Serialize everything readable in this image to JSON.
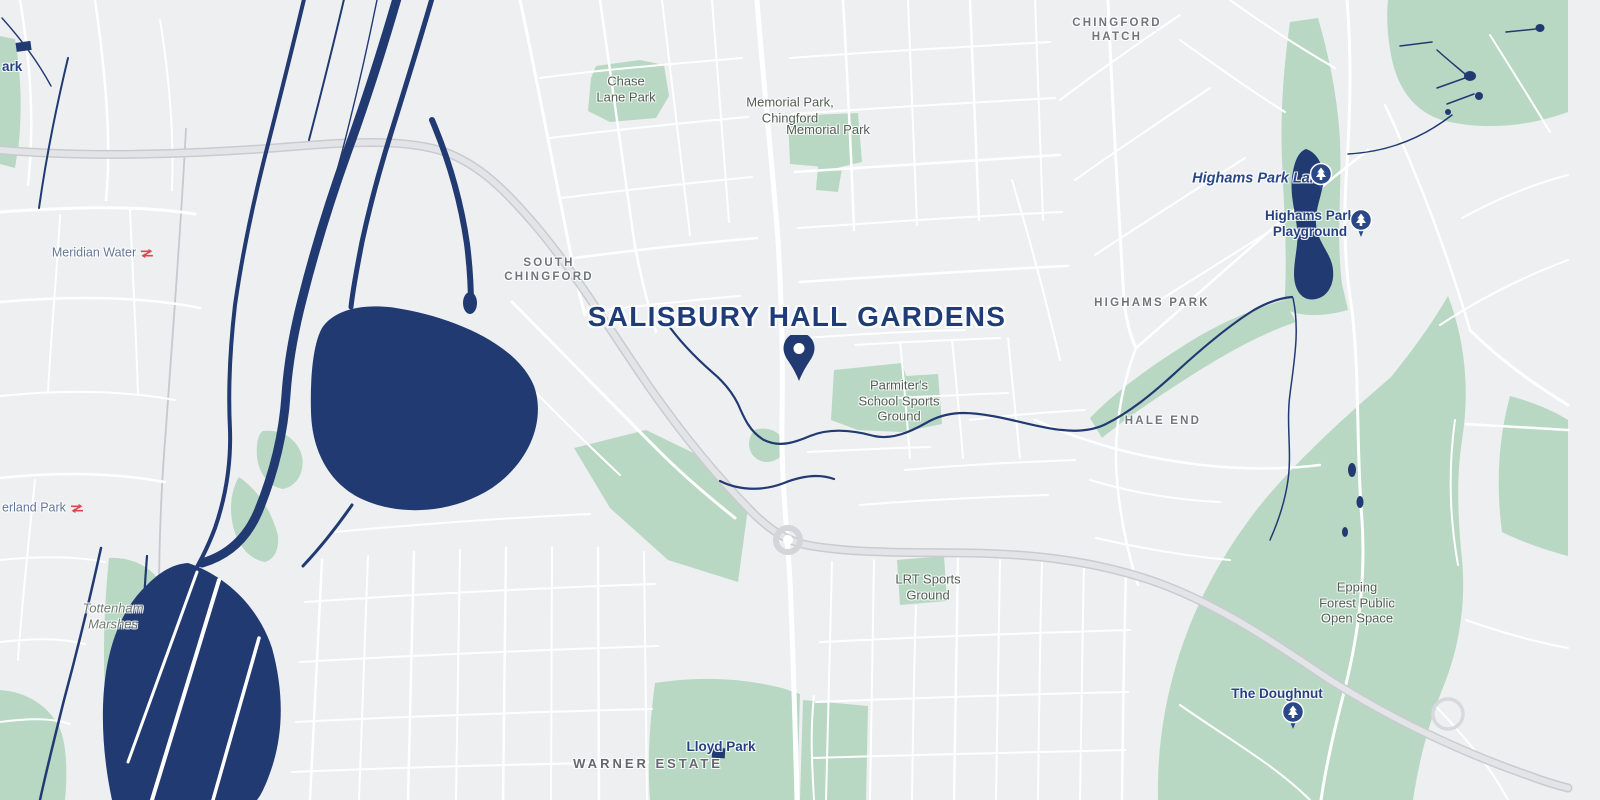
{
  "map": {
    "marker": {
      "title": "SALISBURY HALL GARDENS",
      "icon": "map-pin-icon"
    },
    "colors": {
      "bg": "#edeff1",
      "road": "#ffffff",
      "hwy": "#e3e4e7",
      "hwycase": "#c9cbcf",
      "water": "#223a72",
      "green": "#b8d8c3",
      "navy": "#1e3c78"
    },
    "icons": {
      "location_pin": "map-pin-icon",
      "tree_pin": "tree-pin-icon",
      "rail": "national-rail-icon"
    },
    "labels": [
      {
        "text": "CHINGFORD\nHATCH",
        "type": "area",
        "x": 1117,
        "y": 31
      },
      {
        "text": "SOUTH\nCHINGFORD",
        "type": "area",
        "x": 549,
        "y": 271
      },
      {
        "text": "HIGHAMS PARK",
        "type": "area",
        "x": 1152,
        "y": 304
      },
      {
        "text": "HALE END",
        "type": "area",
        "x": 1163,
        "y": 422
      },
      {
        "text": "WARNER ESTATE",
        "type": "area-lg",
        "x": 648,
        "y": 764
      },
      {
        "text": "Chase\nLane Park",
        "type": "park",
        "x": 626,
        "y": 89
      },
      {
        "text": "Memorial Park,\nChingford",
        "type": "park",
        "x": 790,
        "y": 110
      },
      {
        "text": "Memorial Park",
        "type": "park",
        "x": 828,
        "y": 130
      },
      {
        "text": "Parmiter's\nSchool Sports\nGround",
        "type": "park",
        "x": 899,
        "y": 401
      },
      {
        "text": "LRT Sports\nGround",
        "type": "park",
        "x": 928,
        "y": 587
      },
      {
        "text": "Epping\nForest Public\nOpen Space",
        "type": "park",
        "x": 1357,
        "y": 603
      },
      {
        "text": "The Doughnut",
        "type": "poi",
        "x": 1277,
        "y": 694
      },
      {
        "text": "Lloyd Park",
        "type": "poi",
        "x": 721,
        "y": 747
      },
      {
        "text": "Highams Park\nPlayground",
        "type": "poi",
        "x": 1310,
        "y": 224
      },
      {
        "text": "Highams Park Lake",
        "type": "water",
        "x": 1259,
        "y": 179
      },
      {
        "text": "Tottenham\nMarshes",
        "type": "marsh",
        "x": 113,
        "y": 616
      },
      {
        "text": "Meridian Water",
        "type": "station",
        "x": 103,
        "y": 253,
        "anchor": "center",
        "rail_icon": true
      },
      {
        "text": "erland Park",
        "type": "station",
        "x": 2,
        "y": 508,
        "anchor": "left",
        "rail_icon": true
      },
      {
        "text": "ark",
        "type": "poi",
        "x": 2,
        "y": 67,
        "anchor": "left"
      }
    ],
    "pins": [
      {
        "kind": "location",
        "x": 799,
        "y": 381,
        "name": "salisbury-hall-gardens-pin"
      },
      {
        "kind": "tree",
        "x": 1321,
        "y": 174,
        "name": "highams-park-lake-tree-pin"
      },
      {
        "kind": "tree",
        "x": 1361,
        "y": 220,
        "name": "highams-park-playground-tree-pin"
      },
      {
        "kind": "tree",
        "x": 1293,
        "y": 712,
        "name": "the-doughnut-tree-pin"
      }
    ]
  }
}
